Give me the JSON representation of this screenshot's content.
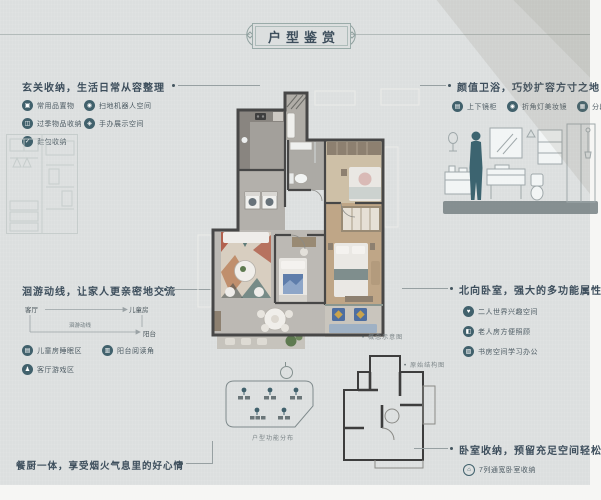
{
  "title": "户型鉴赏",
  "colors": {
    "panel_bg": "#dcdfdf",
    "heading_text": "#3d4e5c",
    "icon_bg": "#41616c",
    "wall": "#474747",
    "rug_red": "#b2614e",
    "rug_teal": "#5f7b78",
    "balcony_blue": "#4d6ea1"
  },
  "sections": {
    "entry": {
      "heading": "玄关收纳，生活日常从容整理",
      "items": [
        {
          "icon": "storage-box-icon",
          "glyph": "▣",
          "label": "常用品置物"
        },
        {
          "icon": "robot-vacuum-icon",
          "glyph": "◉",
          "label": "扫地机器人空间"
        },
        {
          "icon": "seasonal-storage-icon",
          "glyph": "◫",
          "label": "过季物品收纳"
        },
        {
          "icon": "figurine-display-icon",
          "glyph": "◈",
          "label": "手办展示空间"
        },
        {
          "icon": "shoe-bag-icon",
          "glyph": "✓",
          "label": "鞋包收纳"
        }
      ]
    },
    "flow": {
      "heading": "洄游动线，让家人更亲密地交流",
      "diagram": {
        "node_living": "客厅",
        "node_child": "儿童房",
        "node_balcony": "阳台",
        "path_label": "洄游动线"
      },
      "items": [
        {
          "icon": "bed-icon",
          "glyph": "▤",
          "label": "儿童房睡眠区"
        },
        {
          "icon": "book-icon",
          "glyph": "▥",
          "label": "阳台阅读角"
        },
        {
          "icon": "game-icon",
          "glyph": "♟",
          "label": "客厅游戏区"
        }
      ]
    },
    "dining": {
      "heading": "餐厨一体，享受烟火气息里的好心情"
    },
    "bath": {
      "heading": "颜值卫浴，巧妙扩容方寸之地",
      "items": [
        {
          "icon": "mirror-cabinet-icon",
          "glyph": "▤",
          "label": "上下镜柜"
        },
        {
          "icon": "makeup-mirror-icon",
          "glyph": "◉",
          "label": "折角灯美妆镜"
        },
        {
          "icon": "sectional-storage-icon",
          "glyph": "▦",
          "label": "分段式收纳"
        }
      ]
    },
    "north_bedroom": {
      "heading": "北向卧室，强大的多功能属性",
      "items": [
        {
          "icon": "couple-icon",
          "glyph": "♥",
          "label": "二人世界兴趣空间"
        },
        {
          "icon": "elder-care-icon",
          "glyph": "◧",
          "label": "老人房方便照顾"
        },
        {
          "icon": "study-desk-icon",
          "glyph": "▨",
          "label": "书房空间学习办公"
        }
      ]
    },
    "bedroom_storage": {
      "heading": "卧室收纳，预留充足空间轻松换季",
      "items": [
        {
          "icon": "wardrobe-icon",
          "glyph": "⌂",
          "label": "7列通宽卧室收纳"
        }
      ]
    }
  },
  "captions": {
    "concept": "概念示意图",
    "structure": "原始结构图",
    "functions": "户型功能分布"
  }
}
